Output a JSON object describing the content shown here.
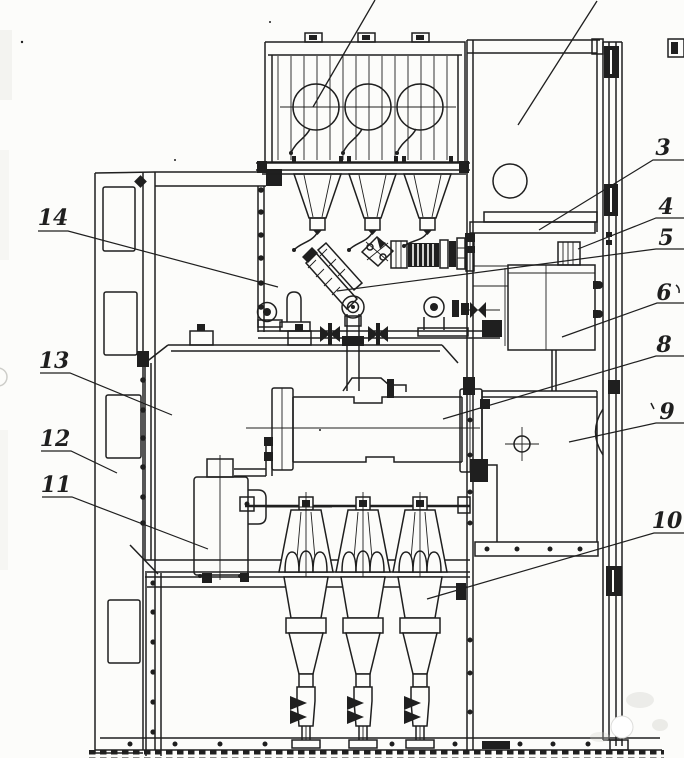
{
  "figure": {
    "kind": "switchgear-sectional-engineering-drawing",
    "ink": "#1f1f1f",
    "paper": "#fcfcfa",
    "width": 684,
    "height": 758
  },
  "callouts": [
    {
      "id": "3",
      "label": "3",
      "text_x": 663,
      "text_y": 148,
      "leader": [
        [
          684,
          160
        ],
        [
          653,
          160
        ],
        [
          539,
          230
        ]
      ]
    },
    {
      "id": "4",
      "label": "4",
      "text_x": 666,
      "text_y": 207,
      "leader": [
        [
          684,
          218
        ],
        [
          656,
          218
        ],
        [
          578,
          249
        ]
      ]
    },
    {
      "id": "5",
      "label": "5",
      "text_x": 666,
      "text_y": 238,
      "leader": [
        [
          684,
          249
        ],
        [
          656,
          249
        ],
        [
          337,
          291
        ]
      ]
    },
    {
      "id": "6",
      "label": "6",
      "text_x": 664,
      "text_y": 293,
      "leader": [
        [
          684,
          303
        ],
        [
          657,
          303
        ],
        [
          562,
          337
        ]
      ],
      "tick_after": true
    },
    {
      "id": "8",
      "label": "8",
      "text_x": 664,
      "text_y": 345,
      "leader": [
        [
          684,
          356
        ],
        [
          656,
          356
        ],
        [
          443,
          419
        ]
      ]
    },
    {
      "id": "9",
      "label": "9",
      "text_x": 667,
      "text_y": 412,
      "leader": [
        [
          684,
          423
        ],
        [
          656,
          423
        ],
        [
          569,
          442
        ]
      ],
      "tick_before": true
    },
    {
      "id": "10",
      "label": "10",
      "text_x": 667,
      "text_y": 521,
      "leader": [
        [
          684,
          533
        ],
        [
          654,
          533
        ],
        [
          427,
          599
        ]
      ]
    },
    {
      "id": "11",
      "label": "11",
      "text_x": 56,
      "text_y": 485,
      "leader": [
        [
          42,
          497
        ],
        [
          72,
          497
        ],
        [
          208,
          549
        ]
      ]
    },
    {
      "id": "12",
      "label": "12",
      "text_x": 55,
      "text_y": 439,
      "leader": [
        [
          41,
          451
        ],
        [
          71,
          451
        ],
        [
          117,
          473
        ]
      ]
    },
    {
      "id": "13",
      "label": "13",
      "text_x": 54,
      "text_y": 361,
      "leader": [
        [
          40,
          373
        ],
        [
          70,
          373
        ],
        [
          172,
          415
        ]
      ]
    },
    {
      "id": "14",
      "label": "14",
      "text_x": 53,
      "text_y": 218,
      "leader": [
        [
          38,
          231
        ],
        [
          68,
          231
        ],
        [
          278,
          287
        ]
      ]
    }
  ],
  "cropped_leaders": [
    {
      "id": "leader-to-top-edge-left",
      "points": [
        [
          375,
          0
        ],
        [
          313,
          107
        ]
      ]
    },
    {
      "id": "leader-to-top-edge-right",
      "points": [
        [
          597,
          1
        ],
        [
          518,
          125
        ]
      ]
    }
  ]
}
